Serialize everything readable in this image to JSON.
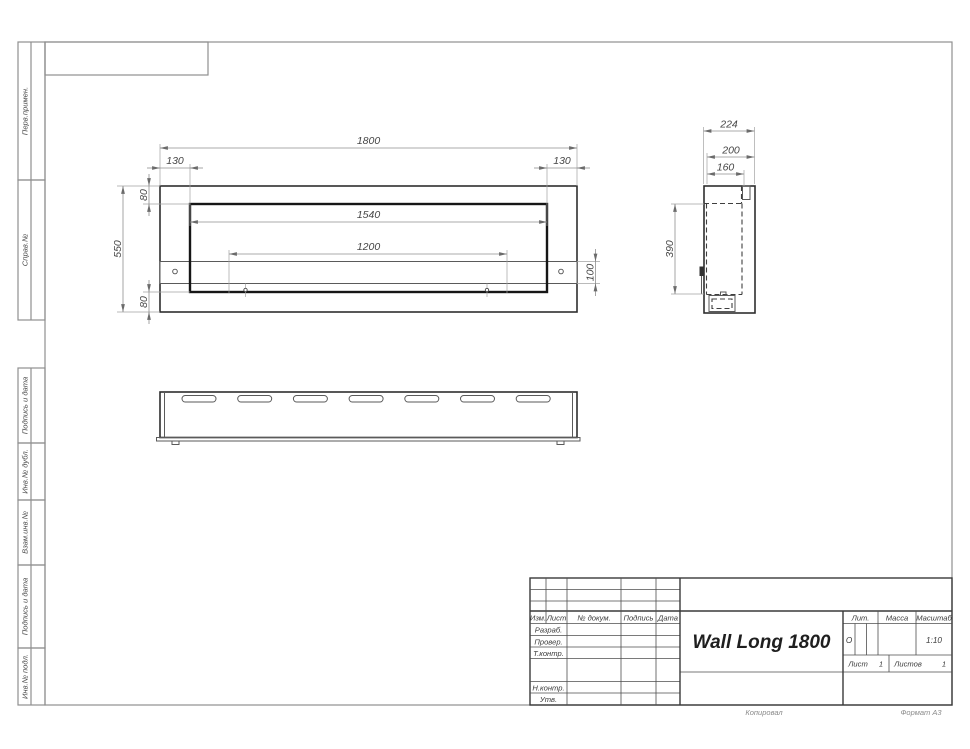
{
  "drawing_title": "Wall Long 1800",
  "margin_labels": [
    "Перв.примен.",
    "Справ.№",
    "Подпись и дата",
    "Инв.№ дубл.",
    "Взам.инв.№",
    "Подпись и дата",
    "Инв.№ подл."
  ],
  "dims": {
    "front": {
      "total_width": "1800",
      "offset_left": "130",
      "offset_right": "130",
      "top_inset": "80",
      "opening_width": "1540",
      "mount_spacing": "1200",
      "total_height": "550",
      "shelf_height": "100",
      "bottom_inset": "80"
    },
    "side": {
      "depth": "224",
      "inner_depth": "200",
      "box_depth": "160",
      "opening_height": "390"
    }
  },
  "title_block": {
    "name": "Wall Long 1800",
    "columns": {
      "izm": "Изм.",
      "list": "Лист",
      "doc": "№ докум.",
      "podp": "Подпись",
      "data": "Дата"
    },
    "roles": {
      "razrab": "Разраб.",
      "prover": "Провер.",
      "tkontr": "Т.контр.",
      "nkontr": "Н.контр.",
      "utv": "Утв."
    },
    "lit_label": "Лит.",
    "mass_label": "Масса",
    "scale_label": "Масштаб",
    "lit_value": "О",
    "scale_value": "1:10",
    "list_label": "Лист",
    "list_value": "1",
    "listov_label": "Листов",
    "listov_value": "1"
  },
  "footer": {
    "copy": "Копировал",
    "format": "Формат А3"
  }
}
